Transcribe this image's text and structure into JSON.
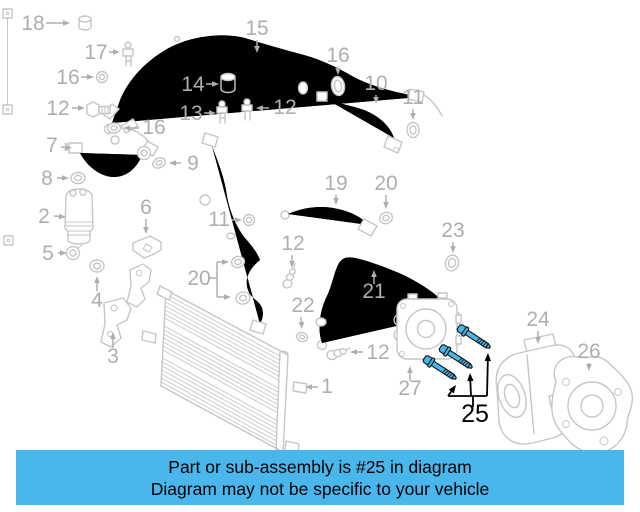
{
  "banner": {
    "line1": "Part or sub-assembly is #25 in diagram",
    "line2": "Diagram may not be specific to your vehicle",
    "bg_color": "#4ab7ec",
    "text_color": "#000000"
  },
  "diagram": {
    "line_color": "#c6c6c6",
    "label_color": "#aeaeae",
    "labels": [
      {
        "text": "18",
        "x": 33,
        "y": 30,
        "arrows": [
          [
            46,
            23,
            70,
            23
          ]
        ]
      },
      {
        "text": "17",
        "x": 96,
        "y": 59,
        "arrows": [
          [
            109,
            52,
            120,
            52
          ]
        ]
      },
      {
        "text": "16",
        "x": 68,
        "y": 84,
        "arrows": [
          [
            81,
            77,
            94,
            77
          ]
        ]
      },
      {
        "text": "12",
        "x": 58,
        "y": 115,
        "arrows": [
          [
            72,
            108,
            85,
            108
          ]
        ]
      },
      {
        "text": "16",
        "x": 154,
        "y": 134,
        "arrows": [
          [
            139,
            128,
            123,
            128
          ]
        ]
      },
      {
        "text": "7",
        "x": 52,
        "y": 152,
        "arrows": [
          [
            61,
            147,
            72,
            148
          ]
        ]
      },
      {
        "text": "8",
        "x": 47,
        "y": 185,
        "arrows": [
          [
            57,
            178,
            69,
            178
          ]
        ]
      },
      {
        "text": "2",
        "x": 44,
        "y": 223,
        "arrows": [
          [
            54,
            216,
            66,
            217
          ]
        ]
      },
      {
        "text": "5",
        "x": 48,
        "y": 260,
        "arrows": [
          [
            58,
            253,
            67,
            253
          ]
        ]
      },
      {
        "text": "9",
        "x": 193,
        "y": 170,
        "arrows": [
          [
            181,
            163,
            169,
            163
          ]
        ]
      },
      {
        "text": "6",
        "x": 146,
        "y": 214,
        "arrows": [
          [
            146,
            219,
            146,
            234
          ]
        ]
      },
      {
        "text": "4",
        "x": 97,
        "y": 307,
        "arrows": [
          [
            97,
            291,
            97,
            276
          ]
        ]
      },
      {
        "text": "3",
        "x": 113,
        "y": 363,
        "arrows": [
          [
            113,
            348,
            113,
            332
          ]
        ]
      },
      {
        "text": "15",
        "x": 257,
        "y": 35,
        "arrows": [
          [
            257,
            40,
            257,
            53
          ]
        ]
      },
      {
        "text": "14",
        "x": 193,
        "y": 91,
        "arrows": [
          [
            206,
            84,
            219,
            84
          ]
        ]
      },
      {
        "text": "13",
        "x": 191,
        "y": 120,
        "arrows": [
          [
            204,
            113,
            216,
            113
          ]
        ]
      },
      {
        "text": "12",
        "x": 285,
        "y": 114,
        "arrows": [
          [
            269,
            108,
            256,
            108
          ]
        ]
      },
      {
        "text": "16",
        "x": 338,
        "y": 62,
        "arrows": [
          [
            338,
            67,
            338,
            75
          ]
        ]
      },
      {
        "text": "10",
        "x": 376,
        "y": 90,
        "arrows": [
          [
            376,
            95,
            376,
            104
          ]
        ]
      },
      {
        "text": "11",
        "x": 413,
        "y": 104,
        "arrows": [
          [
            413,
            109,
            413,
            120
          ]
        ]
      },
      {
        "text": "11",
        "x": 219,
        "y": 226,
        "arrows": [
          [
            232,
            220,
            242,
            220
          ]
        ]
      },
      {
        "text": "12",
        "x": 293,
        "y": 250,
        "arrows": [
          [
            292,
            255,
            292,
            268
          ]
        ]
      },
      {
        "text": "19",
        "x": 336,
        "y": 190,
        "arrows": [
          [
            336,
            195,
            336,
            205
          ]
        ]
      },
      {
        "text": "20",
        "x": 386,
        "y": 190,
        "arrows": [
          [
            386,
            195,
            386,
            209
          ]
        ]
      },
      {
        "text": "23",
        "x": 453,
        "y": 237,
        "arrows": [
          [
            453,
            242,
            453,
            253
          ]
        ]
      },
      {
        "text": "20",
        "x": 199,
        "y": 285,
        "lines": [
          [
            209,
            278,
            217,
            278
          ],
          [
            217,
            262,
            217,
            297
          ]
        ],
        "arrows": [
          [
            217,
            262,
            229,
            262
          ],
          [
            217,
            297,
            231,
            297
          ]
        ]
      },
      {
        "text": "22",
        "x": 303,
        "y": 312,
        "arrows": [
          [
            301,
            317,
            302,
            329
          ]
        ]
      },
      {
        "text": "21",
        "x": 374,
        "y": 298,
        "arrows": [
          [
            374,
            284,
            374,
            270
          ]
        ]
      },
      {
        "text": "12",
        "x": 378,
        "y": 359,
        "arrows": [
          [
            363,
            352,
            350,
            352
          ]
        ]
      },
      {
        "text": "27",
        "x": 410,
        "y": 395,
        "arrows": [
          [
            410,
            381,
            410,
            366
          ]
        ]
      },
      {
        "text": "24",
        "x": 538,
        "y": 326,
        "arrows": [
          [
            538,
            331,
            538,
            344
          ]
        ]
      },
      {
        "text": "26",
        "x": 589,
        "y": 358,
        "arrows": [
          [
            589,
            363,
            589,
            371
          ]
        ]
      },
      {
        "text": "1",
        "x": 327,
        "y": 393,
        "arrows": [
          [
            318,
            387,
            305,
            387
          ]
        ]
      }
    ]
  },
  "highlight": {
    "part_number": "25",
    "color": "#000000",
    "bolt_fill": "#49b6e9",
    "label": {
      "x": 475,
      "y": 422
    },
    "lines": [
      [
        473,
        407,
        473,
        396
      ],
      [
        448,
        396,
        487,
        396
      ]
    ],
    "arrows": [
      [
        448,
        396,
        456,
        385
      ],
      [
        471,
        396,
        470,
        373
      ],
      [
        487,
        396,
        488,
        353
      ]
    ],
    "bolts": [
      {
        "x": 466,
        "y": 332
      },
      {
        "x": 448,
        "y": 352
      },
      {
        "x": 432,
        "y": 363
      }
    ],
    "bolt_angle": 33,
    "bolt_length": 30
  }
}
